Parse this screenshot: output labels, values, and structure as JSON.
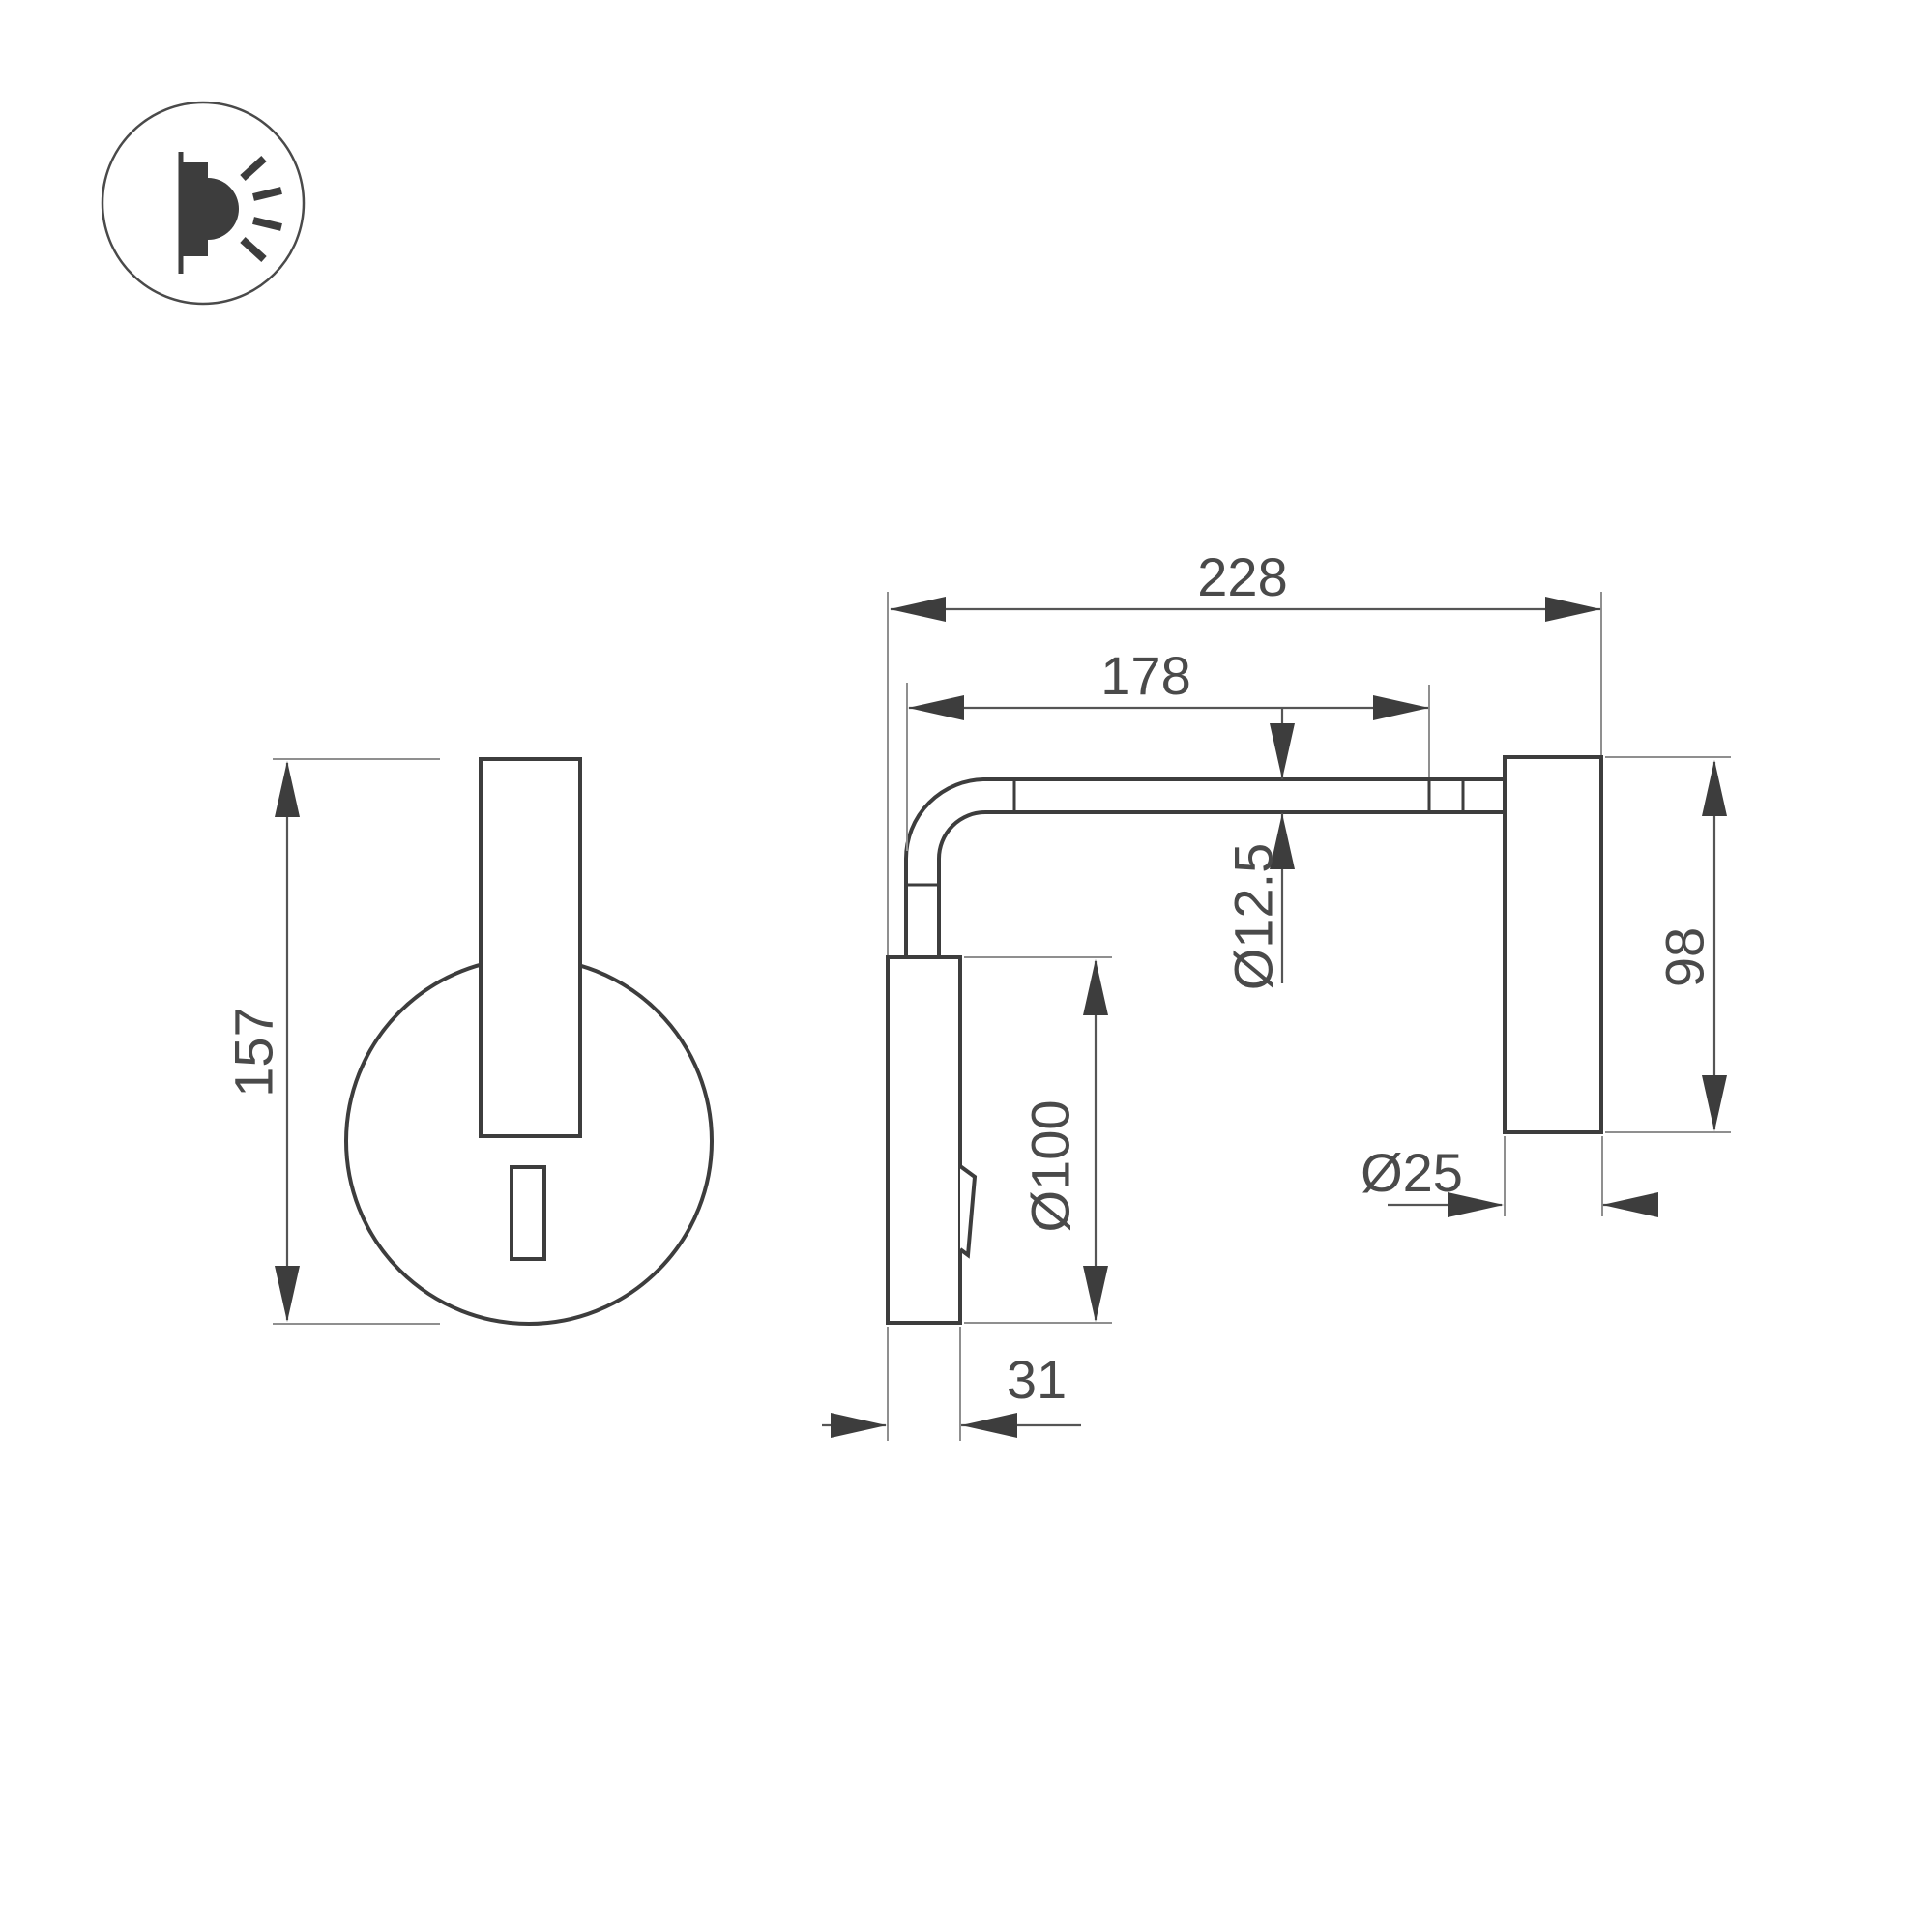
{
  "icon": {
    "name": "wall-lamp-side-icon"
  },
  "front_view": {
    "height": "157"
  },
  "side_view": {
    "overall_depth": "228",
    "arm_length": "178",
    "arm_diameter": "Ø12.5",
    "head_height": "98",
    "head_diameter": "Ø25",
    "plate_diameter": "Ø100",
    "plate_depth": "31"
  },
  "colors": {
    "outline": "#3d3d3d",
    "dimension_text": "#4a4a4a",
    "extension_line": "#8f8f8f",
    "background": "#ffffff"
  }
}
